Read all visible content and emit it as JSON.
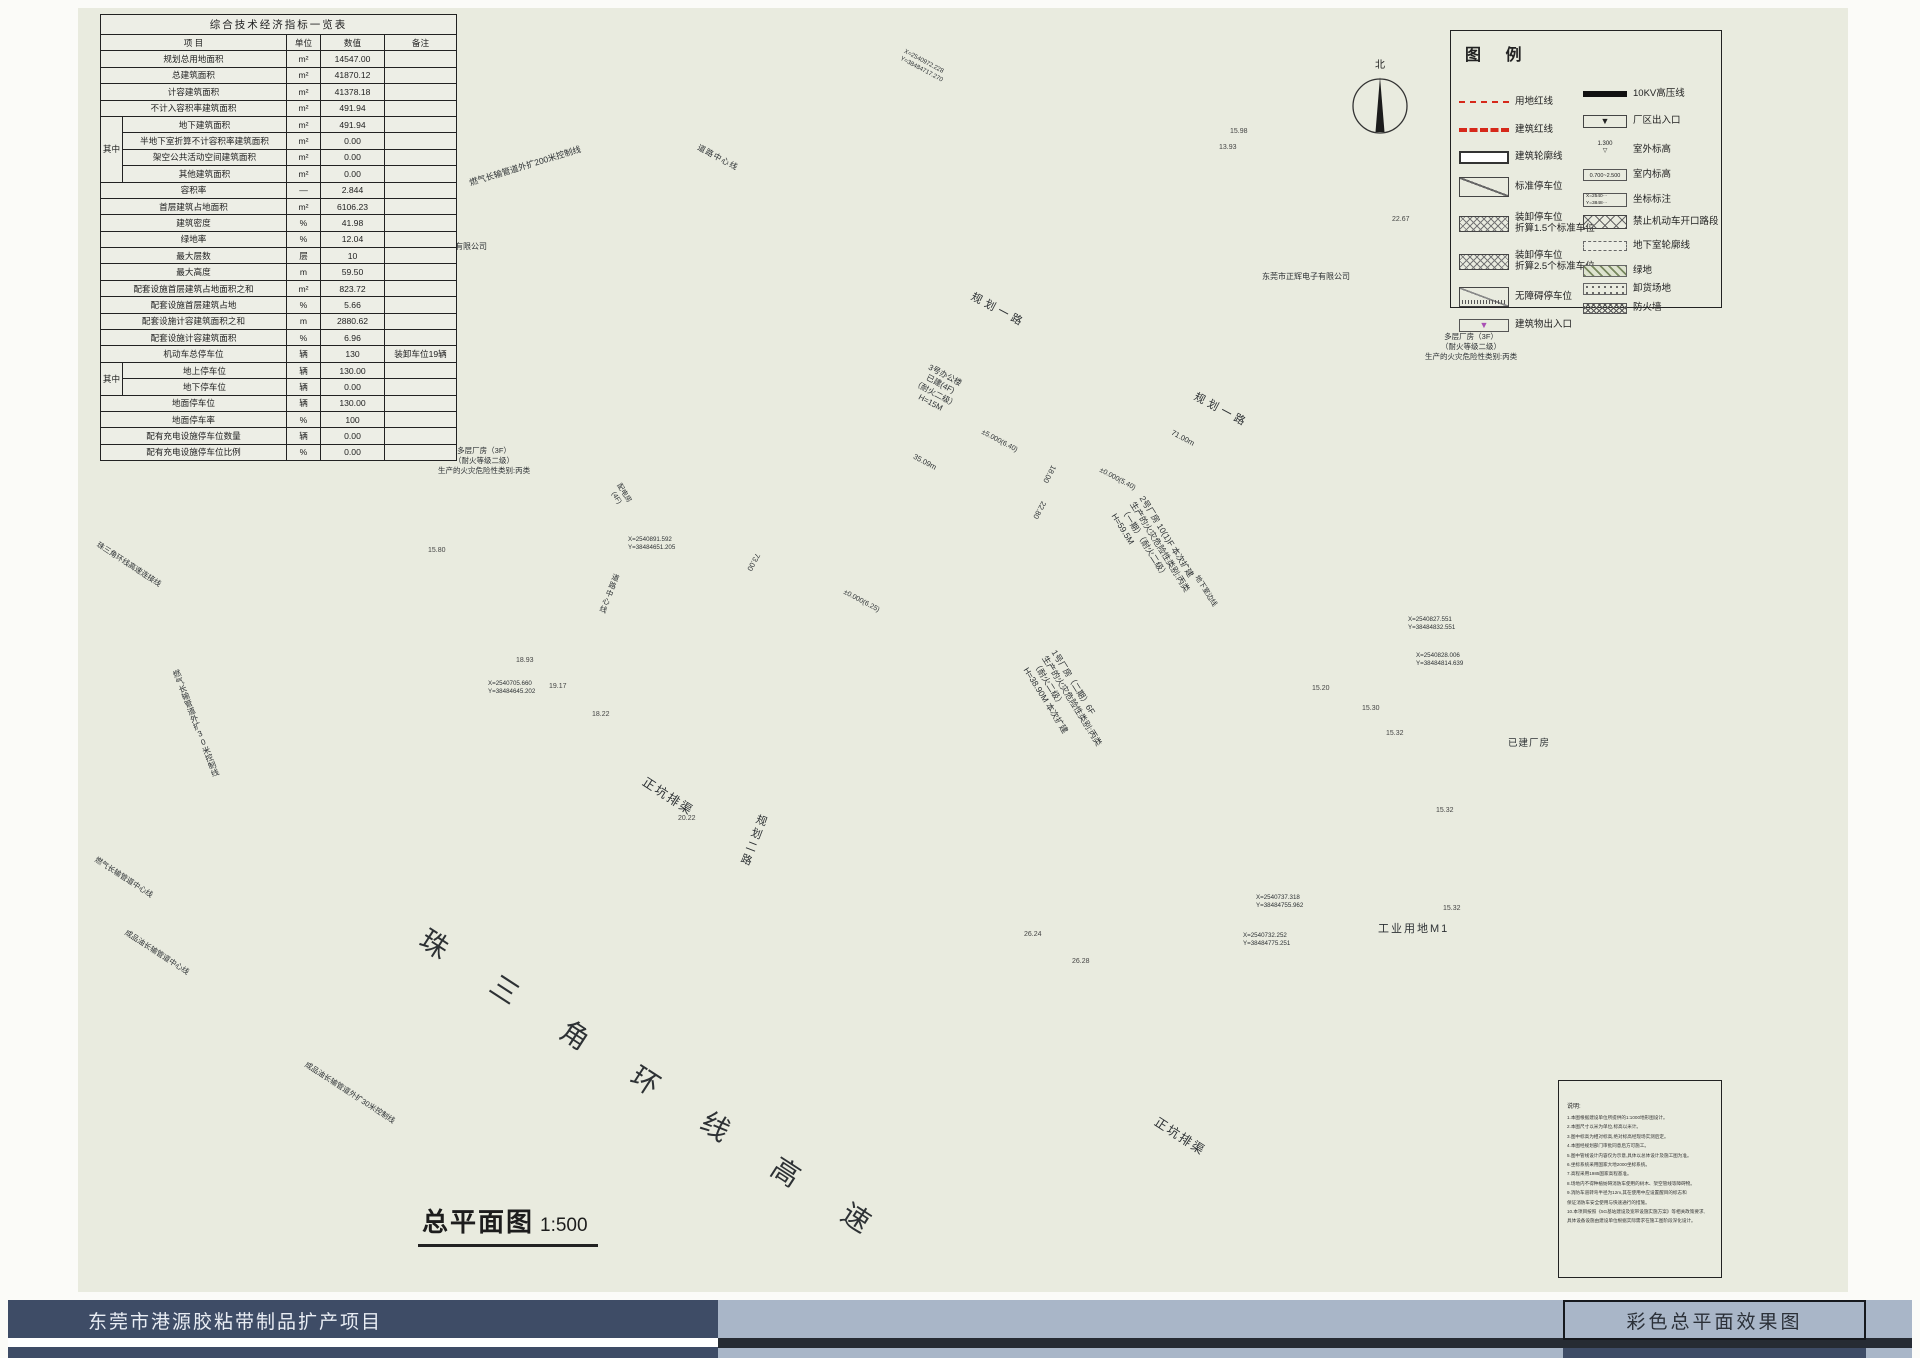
{
  "sheet": {
    "project_title": "东莞市港源胶粘带制品扩产项目",
    "sheet_title": "彩色总平面效果图",
    "drawing_name": "总平面图",
    "drawing_scale": "1:500"
  },
  "north": {
    "label": "北"
  },
  "table": {
    "title": "综合技术经济指标一览表",
    "headers": [
      "项  目",
      "单位",
      "数值",
      "备注"
    ],
    "side_label": "其中",
    "rows": [
      {
        "label": "规划总用地面积",
        "unit": "m²",
        "value": "14547.00",
        "note": "",
        "group": ""
      },
      {
        "label": "总建筑面积",
        "unit": "m²",
        "value": "41870.12",
        "note": "",
        "group": ""
      },
      {
        "label": "计容建筑面积",
        "unit": "m²",
        "value": "41378.18",
        "note": "",
        "group": ""
      },
      {
        "label": "不计入容积率建筑面积",
        "unit": "m²",
        "value": "491.94",
        "note": "",
        "group": ""
      },
      {
        "label": "地下建筑面积",
        "unit": "m²",
        "value": "491.94",
        "note": "",
        "group": "g1"
      },
      {
        "label": "半地下室折算不计容积率建筑面积",
        "unit": "m²",
        "value": "0.00",
        "note": "",
        "group": "g1"
      },
      {
        "label": "架空公共活动空间建筑面积",
        "unit": "m²",
        "value": "0.00",
        "note": "",
        "group": "g1"
      },
      {
        "label": "其他建筑面积",
        "unit": "m²",
        "value": "0.00",
        "note": "",
        "group": "g1"
      },
      {
        "label": "容积率",
        "unit": "—",
        "value": "2.844",
        "note": "",
        "group": ""
      },
      {
        "label": "首层建筑占地面积",
        "unit": "m²",
        "value": "6106.23",
        "note": "",
        "group": ""
      },
      {
        "label": "建筑密度",
        "unit": "%",
        "value": "41.98",
        "note": "",
        "group": ""
      },
      {
        "label": "绿地率",
        "unit": "%",
        "value": "12.04",
        "note": "",
        "group": ""
      },
      {
        "label": "最大层数",
        "unit": "层",
        "value": "10",
        "note": "",
        "group": ""
      },
      {
        "label": "最大高度",
        "unit": "m",
        "value": "59.50",
        "note": "",
        "group": ""
      },
      {
        "label": "配套设施首层建筑占地面积之和",
        "unit": "m²",
        "value": "823.72",
        "note": "",
        "group": ""
      },
      {
        "label": "配套设施首层建筑占地",
        "unit": "%",
        "value": "5.66",
        "note": "",
        "group": ""
      },
      {
        "label": "配套设施计容建筑面积之和",
        "unit": "m",
        "value": "2880.62",
        "note": "",
        "group": ""
      },
      {
        "label": "配套设施计容建筑面积",
        "unit": "%",
        "value": "6.96",
        "note": "",
        "group": ""
      },
      {
        "label": "机动车总停车位",
        "unit": "辆",
        "value": "130",
        "note": "装卸车位19辆",
        "group": ""
      },
      {
        "label": "地上停车位",
        "unit": "辆",
        "value": "130.00",
        "note": "",
        "group": "g2"
      },
      {
        "label": "地下停车位",
        "unit": "辆",
        "value": "0.00",
        "note": "",
        "group": "g2"
      },
      {
        "label": "地面停车位",
        "unit": "辆",
        "value": "130.00",
        "note": "",
        "group": ""
      },
      {
        "label": "地面停车率",
        "unit": "%",
        "value": "100",
        "note": "",
        "group": ""
      },
      {
        "label": "配有充电设施停车位数量",
        "unit": "辆",
        "value": "0.00",
        "note": "",
        "group": ""
      },
      {
        "label": "配有充电设施停车位比例",
        "unit": "%",
        "value": "0.00",
        "note": "",
        "group": ""
      }
    ]
  },
  "legend": {
    "title": "图  例",
    "items_left": [
      {
        "icon": "red-thin",
        "label": "用地红线"
      },
      {
        "icon": "red-thick",
        "label": "建筑红线"
      },
      {
        "icon": "outline",
        "label": "建筑轮廓线"
      },
      {
        "icon": "stall",
        "label": "标准停车位"
      },
      {
        "icon": "stall15",
        "label": "装卸停车位\n折算1.5个标准车位"
      },
      {
        "icon": "stall25",
        "label": "装卸停车位\n折算2.5个标准车位"
      },
      {
        "icon": "acc",
        "label": "无障碍停车位"
      },
      {
        "icon": "entry",
        "label": "建筑物出入口"
      }
    ],
    "items_right": [
      {
        "icon": "hv",
        "label": "10KV高压线"
      },
      {
        "icon": "gate",
        "label": "厂区出入口"
      },
      {
        "icon": "extlvl",
        "label": "室外标高"
      },
      {
        "icon": "intlvl",
        "label": "室内标高"
      },
      {
        "icon": "coord",
        "label": "坐标标注"
      },
      {
        "icon": "noopen",
        "label": "禁止机动车开口路段"
      },
      {
        "icon": "base",
        "label": "地下室轮廓线"
      },
      {
        "icon": "green",
        "label": "绿地"
      },
      {
        "icon": "unload",
        "label": "卸货场地"
      },
      {
        "icon": "fire",
        "label": "防火墙"
      }
    ],
    "icon_texts": {
      "ext_level": "1.300",
      "int_level": "0.700~2.500",
      "coord": "X=2540···\nY=3848···"
    }
  },
  "notes": {
    "title": "说明:",
    "lines": [
      "1.本图根据建设单位所提供的1:1000地形图设计。",
      "2.本图尺寸以米为单位,标高以米计。",
      "3.图中标高为相对标高,绝对标高经现场实测后定。",
      "4.本图经规划部门审批同意后方可施工。",
      "5.图中管线设计内容仅为示意,具体以总体设计及施工图为准。",
      "6.坐标系统采用国家大地2000坐标系统。",
      "7.高程采用1985国家高程基准。",
      "8.场地内不得种植妨碍消防车使用的树木、架空管线等障碍物。",
      "9.消防车道转弯半径为12m,其在使用中应设置醒目的标志和",
      "保证消防车安全使用与快速通行的措施。",
      "10.本项目按照《5G基站建设及宽带设施实施方案》等相关政策要求,",
      "具体设备设施由建设单位根据实际需求在施工图阶段深化设计。"
    ]
  },
  "map": {
    "labels": [
      {
        "id": "ghyl1",
        "text": "规划一路"
      },
      {
        "id": "ghyl2",
        "text": "规划一路"
      },
      {
        "id": "gher1",
        "text": "规划二路"
      },
      {
        "id": "gher2",
        "text": "规划二路"
      },
      {
        "id": "dlzx1",
        "text": "道路中心线"
      },
      {
        "id": "dlzx2",
        "text": "道路中心线"
      },
      {
        "id": "rq200",
        "text": "燃气长输管道外扩200米控制线"
      },
      {
        "id": "rq30",
        "text": "燃气长输管道外扩30米控制线"
      },
      {
        "id": "hwy",
        "text": "珠 三 角 环 线 高 速"
      },
      {
        "id": "zjlj",
        "text": "珠三角环线高速连接线"
      },
      {
        "id": "zk1",
        "text": "正坑排渠"
      },
      {
        "id": "zk2",
        "text": "正坑排渠"
      },
      {
        "id": "rqzx",
        "text": "燃气长输管道中心线"
      },
      {
        "id": "cpzx",
        "text": "成品油长输管道中心线"
      },
      {
        "id": "cp30",
        "text": "成品油长输管道外扩30米控制线"
      },
      {
        "id": "gym1",
        "text": "工业用地M1"
      },
      {
        "id": "yjcf",
        "text": "已建厂房"
      },
      {
        "id": "p13",
        "text": "13"
      },
      {
        "id": "dc1",
        "text": "多层厂房（3F）\n（耐火等级二级）\n生产的火灾危险性类别:丙类"
      },
      {
        "id": "dc2",
        "text": "多层厂房（3F）\n（耐火等级二级）\n生产的火灾危险性类别:丙类"
      },
      {
        "id": "co1",
        "text": "车辉电动车有限公司"
      },
      {
        "id": "co2",
        "text": "东莞市正辉电子有限公司"
      },
      {
        "id": "b3",
        "text": "3号办公楼\n已建(4F)\n（耐火二级）\nH=15M"
      },
      {
        "id": "b3lvl",
        "text": "±5.000(6.40)"
      },
      {
        "id": "b3d1",
        "text": "35.09m"
      },
      {
        "id": "b3d2",
        "text": "18.00"
      },
      {
        "id": "b2",
        "text": "2号厂房 10(1)F 本次扩建\n生产的火灾危险性类别:丙类\n（一期）（耐火二级）\nH=59.5M"
      },
      {
        "id": "b2lvl",
        "text": "±0.000(5.40)"
      },
      {
        "id": "b2dix",
        "text": "地下室边线"
      },
      {
        "id": "b2d1",
        "text": "71.00m"
      },
      {
        "id": "b2d2",
        "text": "22.80"
      },
      {
        "id": "b1",
        "text": "1号厂房（二期）6F\n生产的火灾危险性类别:丙类\n（耐火二级）\nH=38.90M 本次扩建"
      },
      {
        "id": "b1lvl",
        "text": "±0.000(6.25)"
      },
      {
        "id": "b1d1",
        "text": "73.00"
      },
      {
        "id": "pdf",
        "text": "配电房\n(4F)"
      },
      {
        "id": "c1",
        "text": "X=2540972.228\nY=38484717.270"
      },
      {
        "id": "c2",
        "text": "X=2540891.592\nY=38484651.205"
      },
      {
        "id": "c3",
        "text": "X=2540705.660\nY=38484645.202"
      },
      {
        "id": "c4",
        "text": "X=2540827.551\nY=38484832.551"
      },
      {
        "id": "c5",
        "text": "X=2540828.006\nY=38484814.639"
      },
      {
        "id": "c6",
        "text": "X=2540737.318\nY=38484755.962"
      },
      {
        "id": "c7",
        "text": "X=2540732.252\nY=38484775.251"
      }
    ],
    "spot_elevations": [
      {
        "id": "s1",
        "value": "22.67"
      },
      {
        "id": "s2",
        "value": "15.98"
      },
      {
        "id": "s3",
        "value": "13.93"
      },
      {
        "id": "s4",
        "value": "15.30"
      },
      {
        "id": "s5",
        "value": "15.32"
      },
      {
        "id": "s6",
        "value": "15.32"
      },
      {
        "id": "s7",
        "value": "15.32"
      },
      {
        "id": "s8",
        "value": "15.20"
      },
      {
        "id": "s9",
        "value": "18.93"
      },
      {
        "id": "s10",
        "value": "19.17"
      },
      {
        "id": "s11",
        "value": "18.22"
      },
      {
        "id": "s12",
        "value": "20.22"
      },
      {
        "id": "s13",
        "value": "26.24"
      },
      {
        "id": "s14",
        "value": "26.28"
      },
      {
        "id": "s15",
        "value": "15.80"
      }
    ]
  },
  "colors": {
    "paper": "#e9ebdf",
    "boundary_red": "#d6281a",
    "entrance_purple": "#a94fb4",
    "canal_blue": "#bdd6e4",
    "tree_green": "#9cbc77",
    "footer_navy": "#3e4c66",
    "footer_light": "#a9b6c8"
  }
}
